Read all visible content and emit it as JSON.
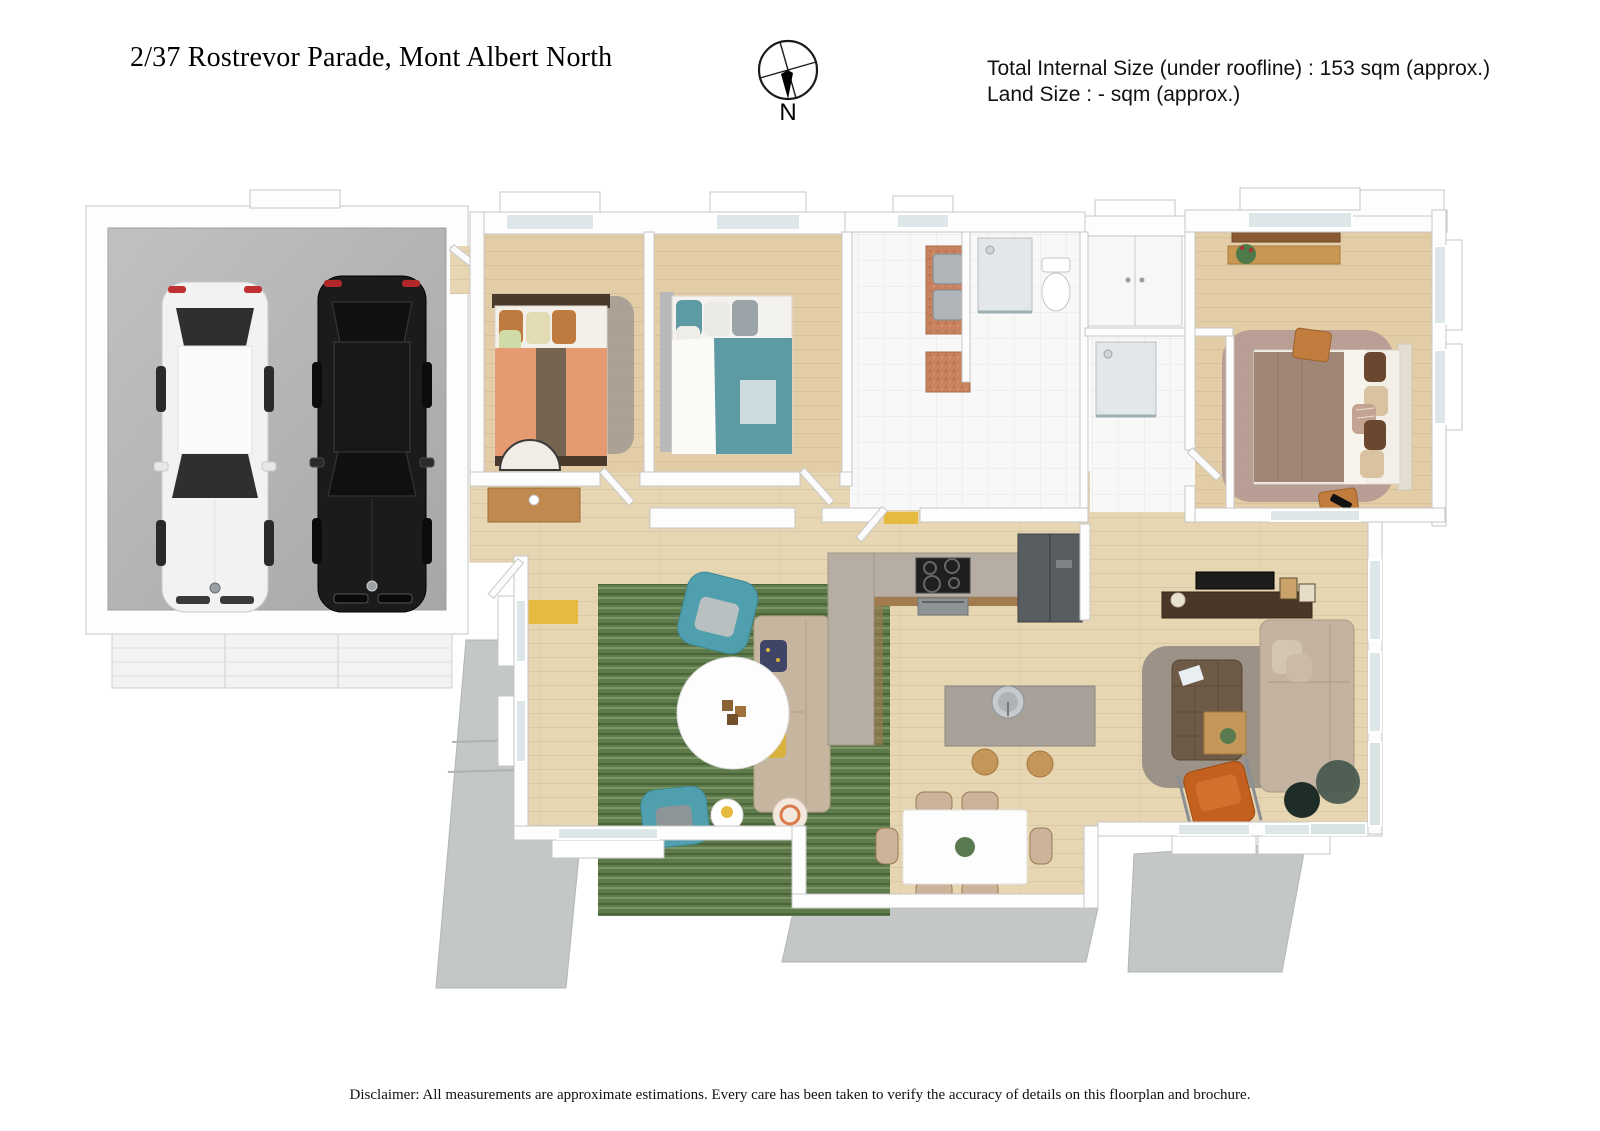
{
  "header": {
    "address": "2/37 Rostrevor Parade, Mont Albert North",
    "compass_label": "N",
    "size_lines": {
      "total": "Total Internal Size (under roofline) :  153 sqm (approx.)",
      "land": "Land Size :  - sqm (approx.)"
    }
  },
  "footer": {
    "disclaimer": "Disclaimer: All measurements are approximate estimations. Every care has been taken to verify the accuracy of details on this floorplan and brochure."
  },
  "floorplan": {
    "type": "3d-render-top-view",
    "palette": {
      "wall": "#fdfdfe",
      "wall_edge": "#c6c6c6",
      "wood_floor": "#e7d6b2",
      "tile_floor": "#f8f8f8",
      "garage_floor": "#b4b5b6",
      "exterior_paving": "#c3c7c5",
      "rug_green": "#5e7b4b",
      "rug_mauve": "#b49a92",
      "rug_grey": "#938b82",
      "teal_chair": "#4f9fae",
      "orange_chair": "#c4601f",
      "sofa_beige": "#c6b6a0",
      "bed_salmon": "#e59a72",
      "bed_brown_stripe": "#75644f",
      "bed_teal": "#5d9aa4",
      "master_quilt": "#a18677",
      "laundry_bench": "#c8825f",
      "counter_taupe": "#b6aea3",
      "accent_yellow": "#e6ba3e",
      "white_car": "#f2f2f2",
      "black_car": "#1b1b1b"
    }
  }
}
